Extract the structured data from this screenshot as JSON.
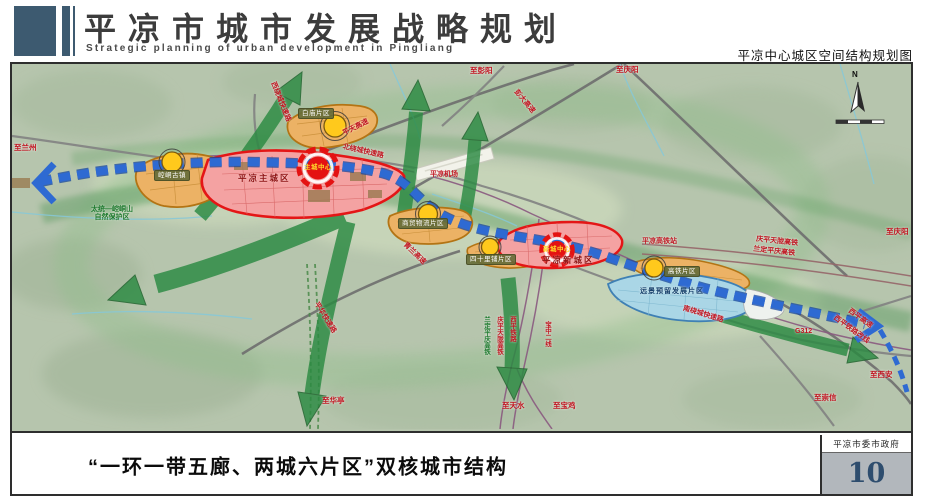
{
  "header": {
    "title": "平凉市城市发展战略规划",
    "subtitle": "Strategic planning of urban development in Pingliang",
    "map_title": "平凉中心城区空间结构规划图"
  },
  "map": {
    "compass": "N",
    "zones": {
      "baimiao": {
        "label": "白庙片区"
      },
      "kongtong": {
        "label": "崆峒古镇"
      },
      "main_city": {
        "label": "平凉主城区",
        "center": "主城中心"
      },
      "shangmao": {
        "label": "商贸物流片区"
      },
      "sishilipu": {
        "label": "四十里铺片区"
      },
      "new_city": {
        "label": "平凉新城区",
        "center": "新城中心"
      },
      "gaotie": {
        "label": "高铁片区"
      },
      "reserve": {
        "label": "远景预留发展片区"
      }
    },
    "nature_reserve": {
      "line1": "太统—崆峒山",
      "line2": "自然保护区"
    },
    "roads": {
      "pingtian": "平天高速",
      "pengda": "彭大高速",
      "north_ring": "北绕城快速路",
      "west_ring": "西绕城快速路",
      "south_ring": "南绕城快速路",
      "qinglan": "青兰高速",
      "pinghua": "平华快速路",
      "airport": "平凉机场",
      "hsr_station": "平凉高铁站",
      "qptl_hsr": "庆平天陇高铁",
      "ldpq_hsr": "兰定平庆高铁",
      "g312": "G312",
      "xiping_expwy": "西平高速",
      "xiping_rail": "西平铁路改线",
      "v_ldpq": "兰定平庆高铁",
      "v_qptl": "庆平天陇高铁",
      "v_xiping": "西平铁路",
      "baozhong": "宝中二线"
    },
    "destinations": {
      "lanzhou": "至兰州",
      "pengyang": "至彭阳",
      "qingyang_top": "至庆阳",
      "qingyang_right": "至庆阳",
      "xian": "至西安",
      "chongxin": "至崇信",
      "tianshui": "至天水",
      "baoji": "至宝鸡",
      "huating": "至华亭"
    }
  },
  "footer": {
    "caption": "“一环一带五廊、两城六片区”双核城市结构",
    "agency": "平凉市委市政府",
    "page_number": "10"
  },
  "colors": {
    "accent_blue": "#3d5a70",
    "belt_blue": "#2e6ad2",
    "corridor_green": "#2b8a42",
    "zone_orange": "#ecb265",
    "zone_red": "#e41616",
    "zone_cyan": "#aad6e6"
  }
}
